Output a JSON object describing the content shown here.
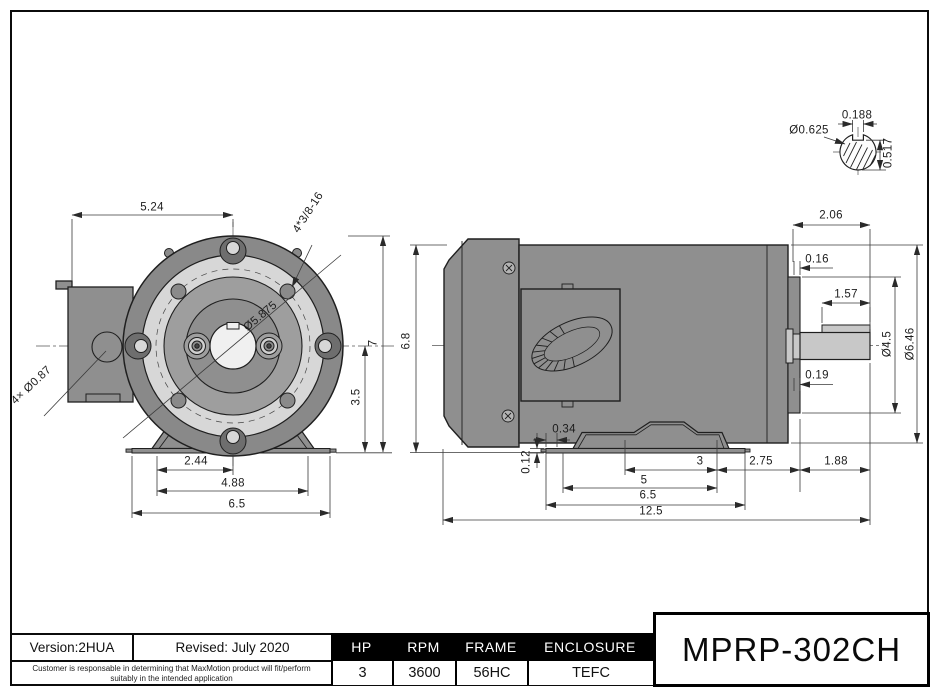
{
  "drawing": {
    "part_number": "MPRP-302CH",
    "front_view": {
      "flange_width": "5.24",
      "bolt_holes_spec": "4*3/8-16",
      "bolt_circle_diameter": "Ø5.875",
      "conduit_holes": "4× Ø0.87",
      "overall_height": "7",
      "shaft_center_height": "3.5",
      "foot_hole_to_center": "2.44",
      "foot_hole_spacing": "4.88",
      "base_width": "6.5"
    },
    "side_view": {
      "frame_height": "6.8",
      "shaft_extension": "2.06",
      "flange_step": "0.16",
      "key_length": "1.57",
      "flange_diameter": "Ø4.5",
      "body_diameter": "Ø6.46",
      "slinger_clearance": "0.19",
      "base_lip": "0.34",
      "base_thickness": "0.12",
      "foot_hole_span_inner": "3",
      "foot_hole_span_outer": "5",
      "base_length": "6.5",
      "overall_length": "12.5",
      "foot_to_flange": "2.75",
      "flange_to_shaft_end": "1.88"
    },
    "shaft_section": {
      "keyway_width": "0.188",
      "shaft_diameter": "Ø0.625",
      "flat_to_bottom": "0.517"
    }
  },
  "title_block": {
    "version": "Version:2HUA",
    "revised": "Revised: July 2020",
    "disclaimer_line1": "Customer is responsable in determining that MaxMotion product will fit/perform",
    "disclaimer_line2": "suitably in the intended application",
    "model": "MPRP-302CH",
    "specs": [
      {
        "label": "HP",
        "value": "3"
      },
      {
        "label": "RPM",
        "value": "3600"
      },
      {
        "label": "FRAME",
        "value": "56HC"
      },
      {
        "label": "ENCLOSURE",
        "value": "TEFC"
      }
    ]
  },
  "colors": {
    "body_gray": "#8f8f8f",
    "outer_ring_gray": "#898989",
    "flange_light": "#d7d7d7",
    "rabbet_gray": "#9e9e9e",
    "shaft_gray": "#c8c8c8",
    "line": "#1f1f1f",
    "dim_line": "#3a3a3a",
    "band_black": "#000000",
    "paper_white": "#ffffff"
  }
}
